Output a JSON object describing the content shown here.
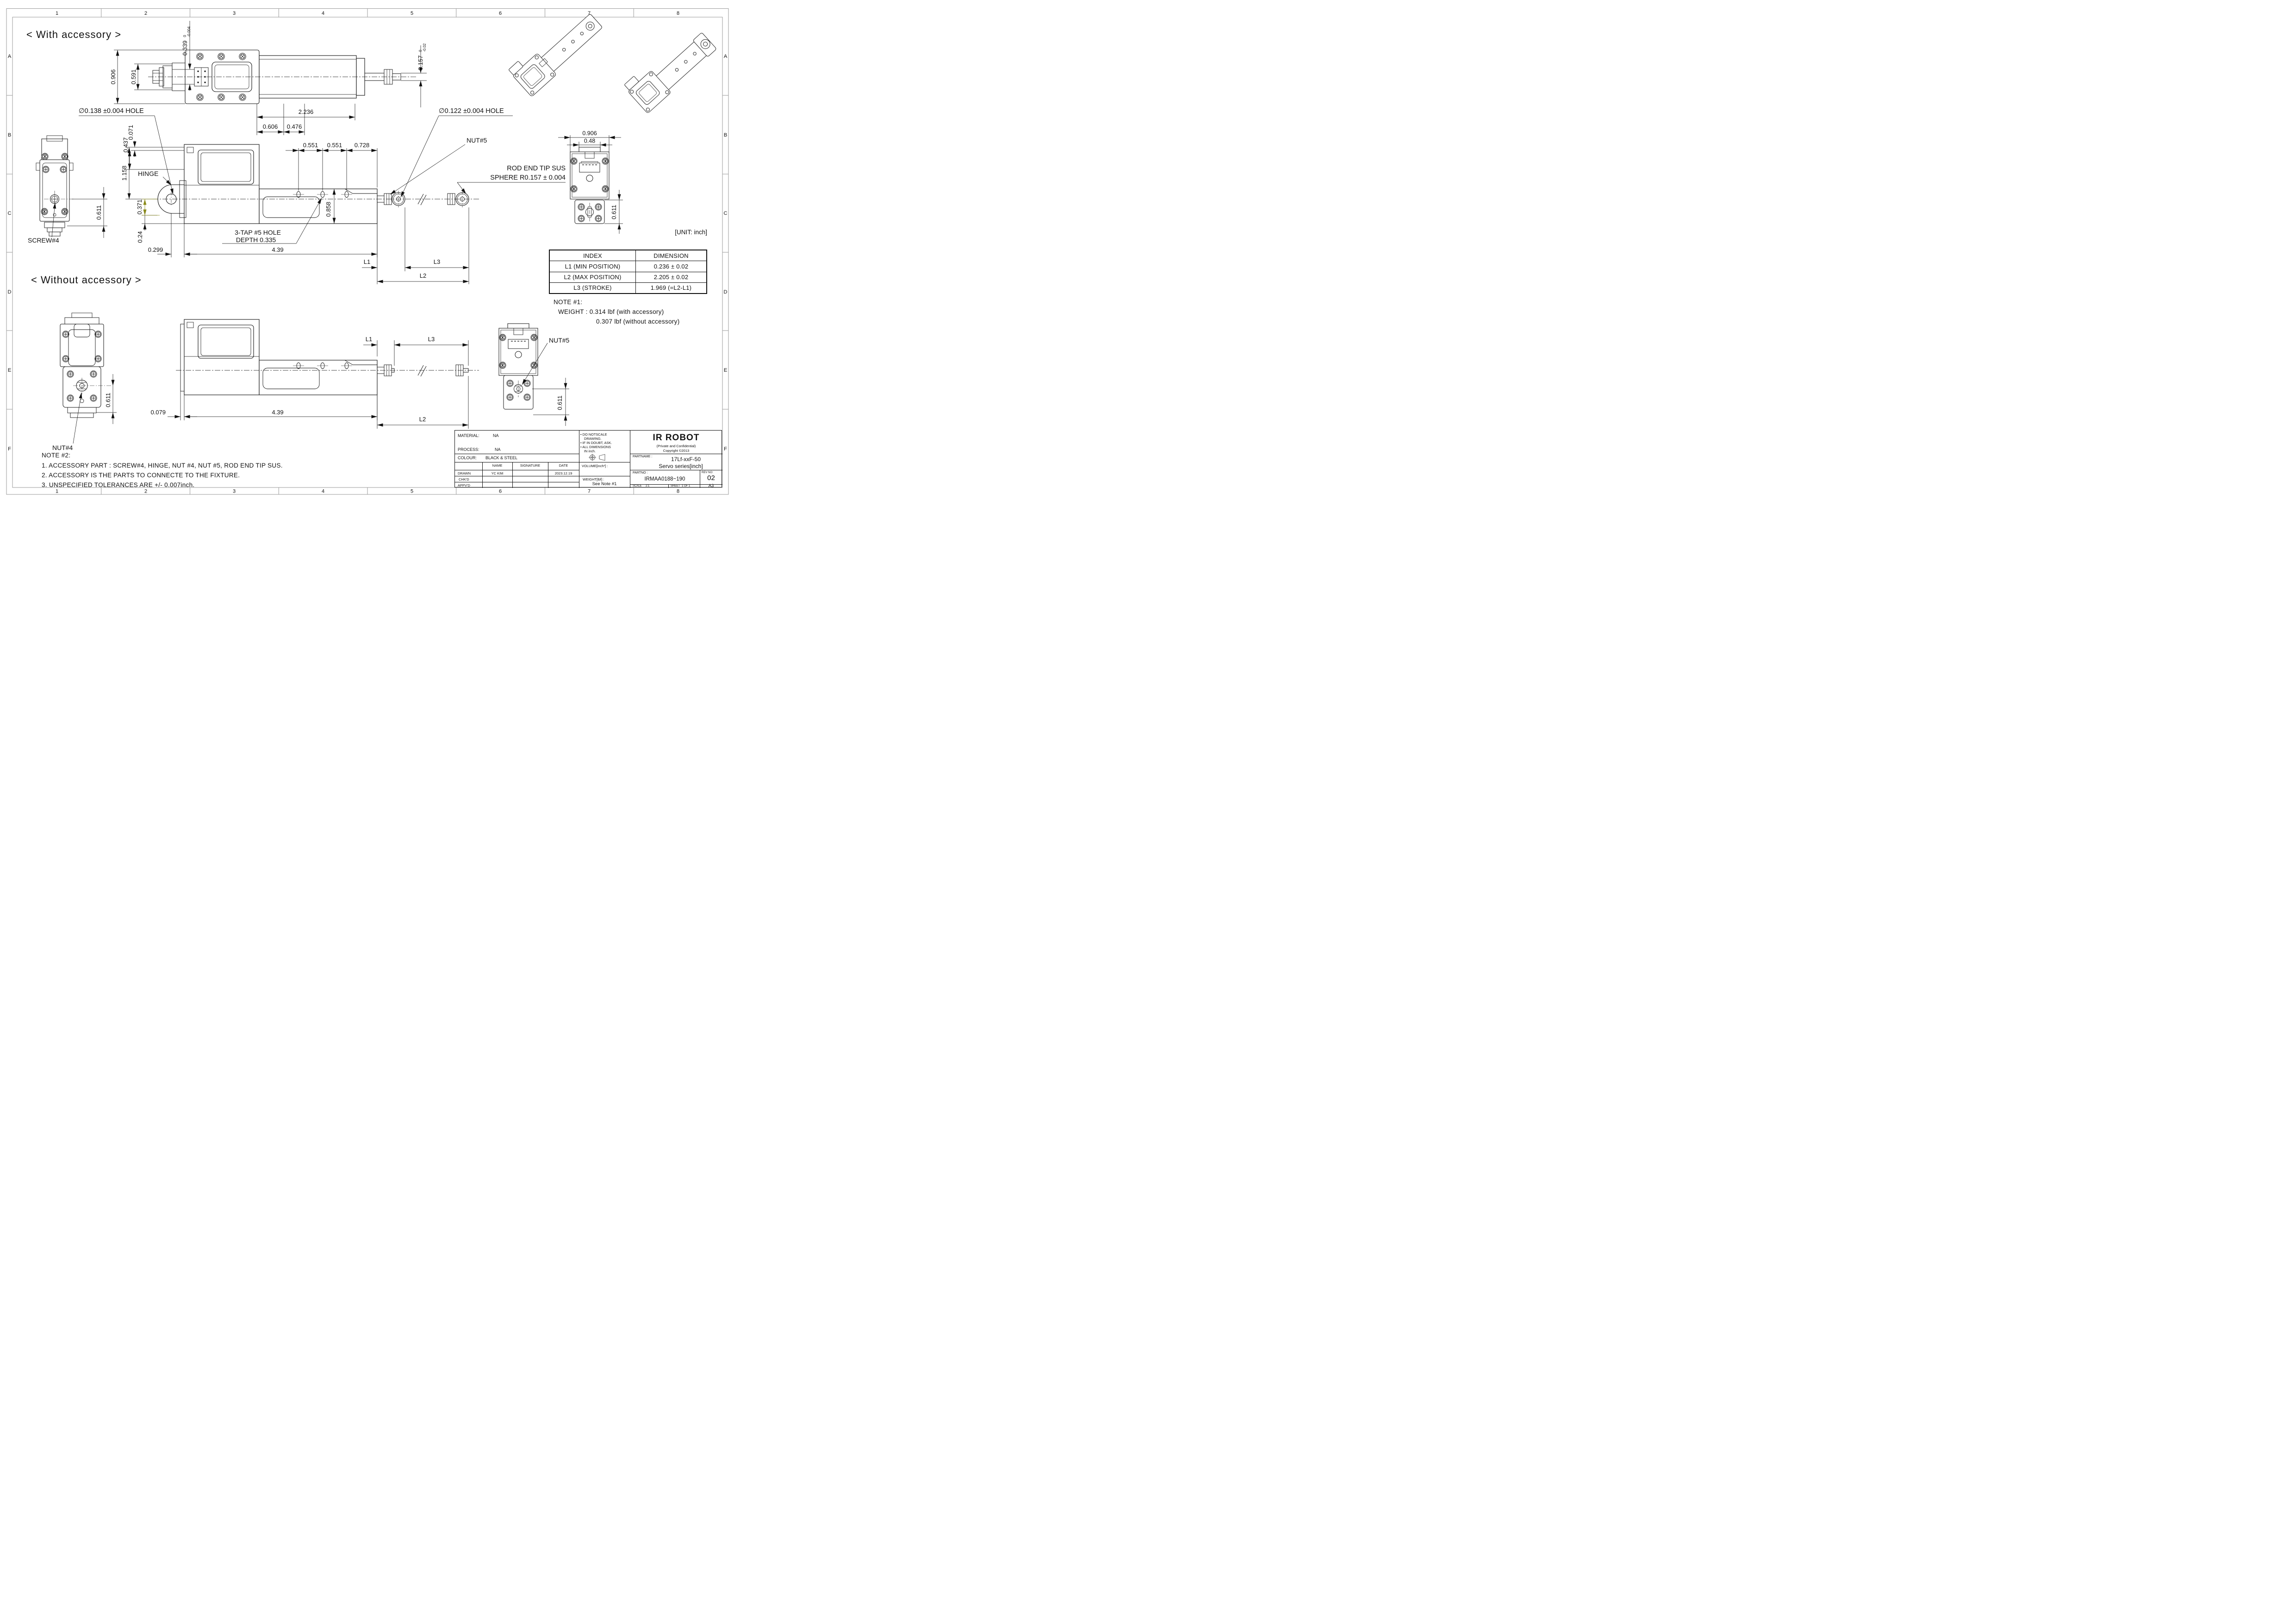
{
  "frame": {
    "cols": [
      "1",
      "2",
      "3",
      "4",
      "5",
      "6",
      "7",
      "8"
    ],
    "rows": [
      "A",
      "B",
      "C",
      "D",
      "E",
      "F"
    ]
  },
  "titles": {
    "with_accessory": "< With accessory >",
    "without_accessory": "< Without accessory >",
    "unit": "[UNIT: inch]"
  },
  "dims": {
    "w906": "0.906",
    "w591": "0.591",
    "w339": "0.339",
    "w339_tol_hi": "0",
    "w339_tol_lo": "-0.004",
    "w157": "0.157",
    "w157_tol_hi": "0",
    "w157_tol_lo": "-0.02",
    "hole138": "∅0.138 ±0.004 HOLE",
    "len2236": "2.236",
    "len606": "0.606",
    "len476": "0.476",
    "v437": "0.437",
    "v071": "0.071",
    "hinge": "HINGE",
    "v1158": "1.158",
    "v371": "0.371",
    "v024": "0.24",
    "h299": "0.299",
    "h439": "4.39",
    "screw4": "SCREW#4",
    "a0611": "0.611",
    "p551a": "0.551",
    "p551b": "0.551",
    "p728": "0.728",
    "v858": "0.858",
    "tap1": "3-TAP #5 HOLE",
    "tap2": "DEPTH 0.335",
    "hole122": "∅0.122 ±0.004 HOLE",
    "nut5": "NUT#5",
    "rod1": "ROD END TIP SUS",
    "rod2": "SPHERE R0.157 ± 0.004",
    "L1": "L1",
    "L2": "L2",
    "L3": "L3",
    "e906": "0.906",
    "e048": "0.48",
    "e0611": "0.611",
    "b0611": "0.611",
    "nut4": "NUT#4",
    "b079": "0.079",
    "b439": "4.39",
    "bL1": "L1",
    "bL2": "L2",
    "bL3": "L3",
    "bnut5": "NUT#5",
    "b0611r": "0.611"
  },
  "index_table": {
    "col1": "INDEX",
    "col2": "DIMENSION",
    "rows": [
      {
        "index": "L1 (MIN POSITION)",
        "dimension": "0.236 ± 0.02"
      },
      {
        "index": "L2 (MAX POSITION)",
        "dimension": "2.205 ± 0.02"
      },
      {
        "index": "L3 (STROKE)",
        "dimension": "1.969 (=L2-L1)"
      }
    ]
  },
  "note1": {
    "title": "NOTE #1:",
    "line1": "WEIGHT : 0.314 lbf  (with accessory)",
    "line2": "0.307 lbf  (without accessory)"
  },
  "note2": {
    "title": "NOTE #2:",
    "line1": "1. ACCESSORY PART :  SCREW#4, HINGE, NUT #4, NUT #5, ROD END TIP SUS.",
    "line2": "2. ACCESSORY IS THE PARTS TO CONNECTE TO THE FIXTURE.",
    "line3": "3. UNSPECIFIED TOLERANCES ARE +/- 0.007inch."
  },
  "title_block": {
    "material_label": "MATERIAL:",
    "material_value": "NA",
    "process_label": "PROCESS:",
    "process_value": "NA",
    "colour_label": "COLOUR:",
    "colour_value": "BLACK & STEEL",
    "name_header": "NAME",
    "signature_header": "SIGNATURE",
    "date_header": "DATE",
    "drawn_label": "DRAWN",
    "drawn_name": "YC KIM",
    "drawn_date": "2023.12.19",
    "chkd_label": "CHK'D",
    "appvd_label": "APPV'D",
    "notes": [
      "• DO NOTSCALE",
      "DRAWING.",
      "• IF IN DOUBT, ASK.",
      "• ALL DIMENSIONS",
      "IN inch."
    ],
    "volume_label": "VOLUME[inch³] :",
    "weight_label": "WEIGHT[lbf] :",
    "weight_value": "See Note #1",
    "company": "IR ROBOT",
    "confidential": "(Private and Confidential)",
    "copyright": "Copyright ©2013",
    "partname_label": "PARTNAME :",
    "partname_value1": "17Lf-xxF-50",
    "partname_value2": "Servo series[inch]",
    "partno_label": "PARTNO :",
    "partno_value": "IRMAA0188~190",
    "revno_label": "REV NO:",
    "revno_value": "02",
    "scale_label": "SCALE",
    "scale_value": "2:1",
    "sheet_label": "SHEET",
    "sheet_value": "1 OF 1",
    "size_value": "A3"
  }
}
